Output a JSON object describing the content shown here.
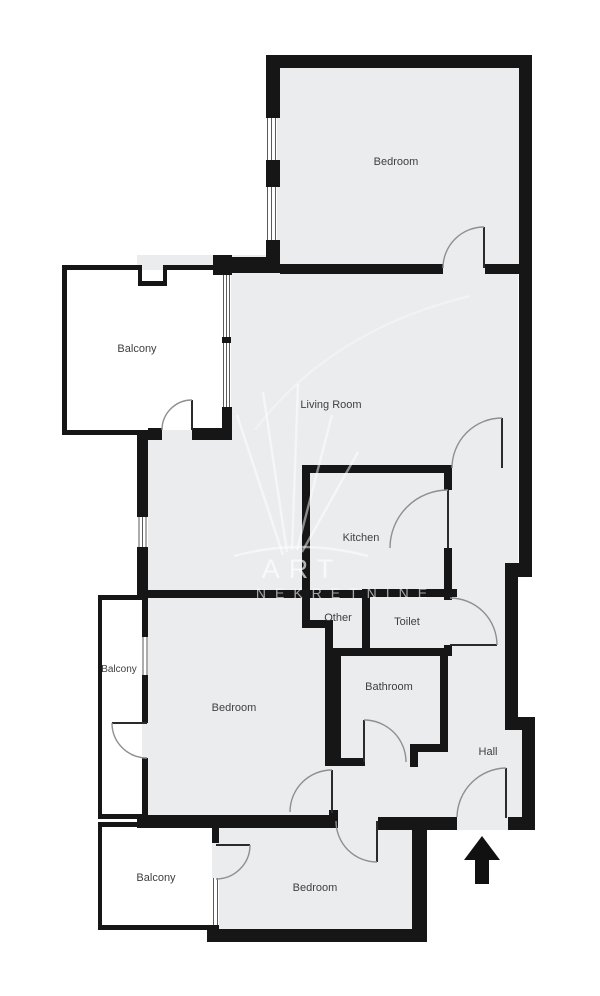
{
  "floorplan": {
    "rooms": {
      "bedroom_top": {
        "label": "Bedroom"
      },
      "balcony_top": {
        "label": "Balcony"
      },
      "living_room": {
        "label": "Living Room"
      },
      "kitchen": {
        "label": "Kitchen"
      },
      "other": {
        "label": "Other"
      },
      "toilet": {
        "label": "Toilet"
      },
      "balcony_mid": {
        "label": "Balcony"
      },
      "bedroom_mid": {
        "label": "Bedroom"
      },
      "bathroom": {
        "label": "Bathroom"
      },
      "hall": {
        "label": "Hall"
      },
      "balcony_bottom": {
        "label": "Balcony"
      },
      "bedroom_bottom": {
        "label": "Bedroom"
      }
    },
    "watermark": {
      "line1": "ART",
      "line2": "NEKRETNINE"
    },
    "entrance": {
      "indicator": "up-arrow"
    },
    "colors": {
      "background": "#ffffff",
      "room_fill": "#ebecee",
      "balcony_fill": "#ffffff",
      "wall": "#161616",
      "door_arc": "#8f8f8f",
      "label_text": "#3f3f3f",
      "watermark": "rgba(255,255,255,0.65)"
    }
  }
}
